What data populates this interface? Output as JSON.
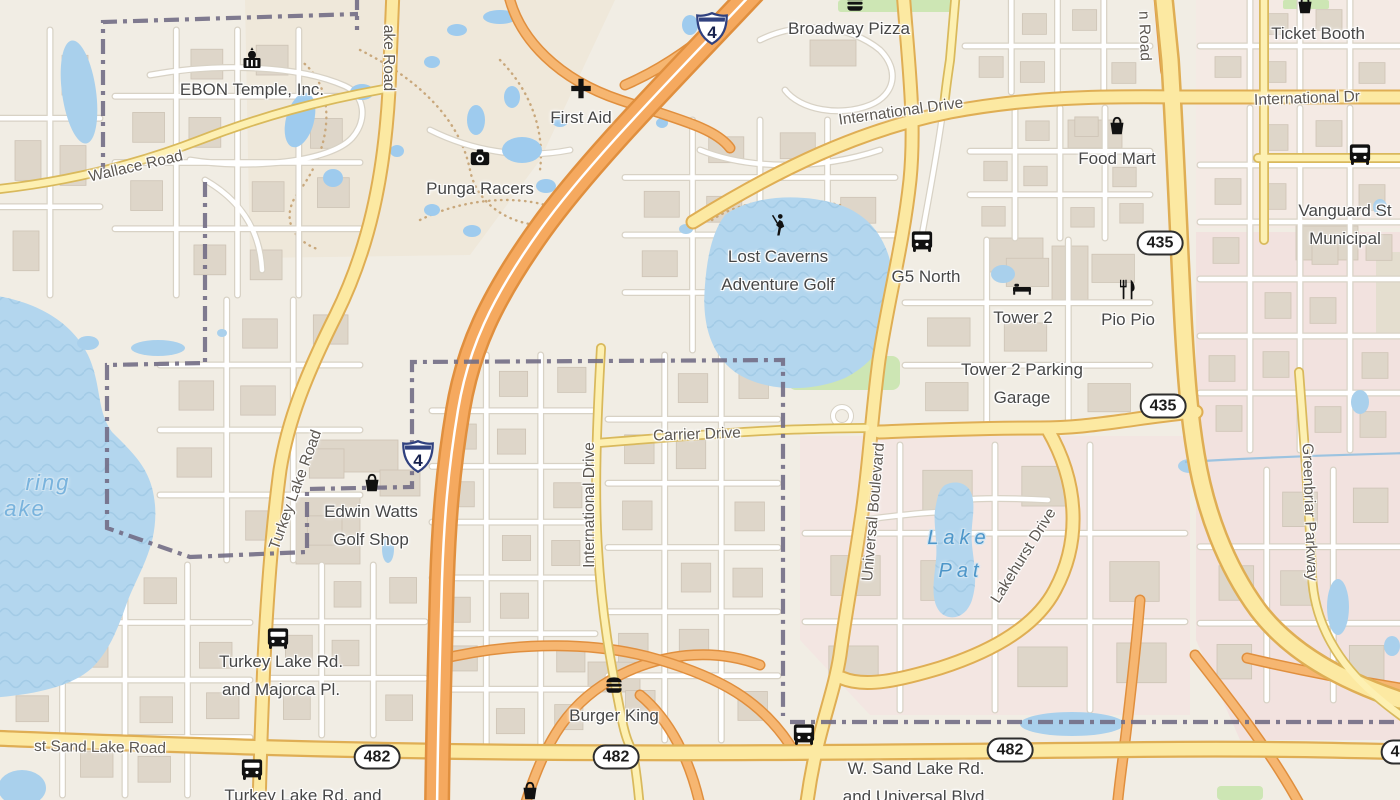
{
  "map": {
    "colors": {
      "land": "#f1ede4",
      "water": "#b3d6ee",
      "pool": "#9ecbee",
      "pond": "#a9d0ec",
      "building": "#ded6c9",
      "street": "#ffffff",
      "street_casing": "#d8d2c5",
      "road_fill": "#fce9a2",
      "road_casing": "#dfae54",
      "motorway_fill": "#f5a95f",
      "motorway_casing": "#e08f3e",
      "boundary": "#726d85",
      "grass": "#cde6b4",
      "poi_text": "#474747",
      "road_text": "#5d5852",
      "water_text": "#4d96c9"
    },
    "poi_labels": [
      {
        "lines": [
          "EBON Temple, Inc."
        ],
        "x": 252,
        "y": 90
      },
      {
        "lines": [
          "First Aid"
        ],
        "x": 581,
        "y": 118
      },
      {
        "lines": [
          "Punga Racers"
        ],
        "x": 480,
        "y": 189
      },
      {
        "lines": [
          "Broadway Pizza"
        ],
        "x": 849,
        "y": 29
      },
      {
        "lines": [
          "Ticket Booth"
        ],
        "x": 1318,
        "y": 34
      },
      {
        "lines": [
          "Food Mart"
        ],
        "x": 1117,
        "y": 159
      },
      {
        "lines": [
          "Vanguard St",
          "Municipal"
        ],
        "x": 1345,
        "y": 225
      },
      {
        "lines": [
          "Lost Caverns",
          "Adventure Golf"
        ],
        "x": 778,
        "y": 271
      },
      {
        "lines": [
          "G5 North"
        ],
        "x": 926,
        "y": 277
      },
      {
        "lines": [
          "Tower 2"
        ],
        "x": 1023,
        "y": 318
      },
      {
        "lines": [
          "Pio Pio"
        ],
        "x": 1128,
        "y": 320
      },
      {
        "lines": [
          "Tower 2 Parking",
          "Garage"
        ],
        "x": 1022,
        "y": 384
      },
      {
        "lines": [
          "Edwin Watts",
          "Golf Shop"
        ],
        "x": 371,
        "y": 526
      },
      {
        "lines": [
          "Turkey Lake Rd.",
          "and Majorca Pl."
        ],
        "x": 281,
        "y": 676
      },
      {
        "lines": [
          "Burger King"
        ],
        "x": 614,
        "y": 716
      },
      {
        "lines": [
          "W. Sand Lake Rd.",
          "and Universal Blvd."
        ],
        "x": 916,
        "y": 783
      },
      {
        "lines": [
          "Turkey Lake Rd. and"
        ],
        "x": 303,
        "y": 796
      }
    ],
    "road_labels": [
      {
        "text": "Wallace Road",
        "x": 136,
        "y": 167,
        "rot": -13
      },
      {
        "text": "ake Road",
        "x": 388,
        "y": 58,
        "rot": 90
      },
      {
        "text": "International Drive",
        "x": 901,
        "y": 112,
        "rot": -8
      },
      {
        "text": "International Dr",
        "x": 1307,
        "y": 99,
        "rot": -2
      },
      {
        "text": "n Road",
        "x": 1144,
        "y": 36,
        "rot": 88
      },
      {
        "text": "Carrier Drive",
        "x": 697,
        "y": 435,
        "rot": -2
      },
      {
        "text": "International Drive",
        "x": 590,
        "y": 505,
        "rot": -90
      },
      {
        "text": "Universal Boulevard",
        "x": 874,
        "y": 512,
        "rot": -85
      },
      {
        "text": "Lakehurst Drive",
        "x": 1024,
        "y": 556,
        "rot": -58
      },
      {
        "text": "Greenbriar Parkway",
        "x": 1309,
        "y": 512,
        "rot": 88
      },
      {
        "text": "Turkey Lake Road",
        "x": 296,
        "y": 490,
        "rot": -70
      },
      {
        "text": "st Sand Lake Road",
        "x": 100,
        "y": 748,
        "rot": 1
      }
    ],
    "water_labels": [
      {
        "text": "ring",
        "x": 48,
        "y": 483,
        "big": true
      },
      {
        "text": "ake",
        "x": 25,
        "y": 509,
        "big": true
      },
      {
        "text": "Lake",
        "x": 959,
        "y": 538,
        "big": false
      },
      {
        "text": "Pat",
        "x": 961,
        "y": 571,
        "big": false
      }
    ],
    "shields": {
      "interstate": [
        {
          "text": "4",
          "x": 712,
          "y": 31
        },
        {
          "text": "4",
          "x": 418,
          "y": 459
        }
      ],
      "oval": [
        {
          "text": "435",
          "x": 1160,
          "y": 243
        },
        {
          "text": "435",
          "x": 1163,
          "y": 406
        },
        {
          "text": "482",
          "x": 377,
          "y": 757
        },
        {
          "text": "482",
          "x": 616,
          "y": 757
        },
        {
          "text": "482",
          "x": 1010,
          "y": 750
        },
        {
          "text": "482",
          "x": 1404,
          "y": 752
        }
      ]
    },
    "icons": [
      {
        "name": "temple-icon",
        "x": 252,
        "y": 62,
        "s": 30
      },
      {
        "name": "firstaid-icon",
        "x": 581,
        "y": 91,
        "s": 26
      },
      {
        "name": "camera-icon",
        "x": 480,
        "y": 160,
        "s": 26
      },
      {
        "name": "burger-icon",
        "x": 855,
        "y": 6,
        "s": 26
      },
      {
        "name": "burger-icon",
        "x": 614,
        "y": 688,
        "s": 26
      },
      {
        "name": "basket-icon",
        "x": 1117,
        "y": 129,
        "s": 26
      },
      {
        "name": "basket-icon",
        "x": 1305,
        "y": 8,
        "s": 26
      },
      {
        "name": "basket-icon",
        "x": 372,
        "y": 486,
        "s": 26
      },
      {
        "name": "basket-icon",
        "x": 530,
        "y": 794,
        "s": 26
      },
      {
        "name": "bus-icon",
        "x": 922,
        "y": 244,
        "s": 27
      },
      {
        "name": "bus-icon",
        "x": 1360,
        "y": 157,
        "s": 27
      },
      {
        "name": "bus-icon",
        "x": 278,
        "y": 641,
        "s": 27
      },
      {
        "name": "bus-icon",
        "x": 804,
        "y": 737,
        "s": 27
      },
      {
        "name": "bus-icon",
        "x": 252,
        "y": 772,
        "s": 27
      },
      {
        "name": "bed-icon",
        "x": 1022,
        "y": 290,
        "s": 24
      },
      {
        "name": "restaurant-icon",
        "x": 1128,
        "y": 292,
        "s": 26
      },
      {
        "name": "golfer-icon",
        "x": 777,
        "y": 228,
        "s": 28
      }
    ],
    "geometry": {
      "areas": [
        {
          "path": "M245,0 L615,0 L540,160 L470,255 L250,258 Z",
          "fill": "#efe8da"
        },
        {
          "path": "M1196,0 H1400 V228 H1196 Z",
          "fill": "#f4eae4"
        },
        {
          "path": "M1196,232 H1400 V740 H1240 L1196,640 Z",
          "fill": "#f2e2df"
        },
        {
          "path": "M800,436 L1190,436 L1190,715 L870,715 L800,640 Z",
          "fill": "#f3e6e2"
        },
        {
          "path": "M1376,252 H1400 V334 H1376 Z",
          "fill": "#e4decf"
        }
      ],
      "greens": [
        {
          "x": 788,
          "y": 356,
          "w": 112,
          "h": 34,
          "r": 8
        },
        {
          "x": 838,
          "y": 0,
          "w": 120,
          "h": 12,
          "r": 3
        },
        {
          "x": 1283,
          "y": 0,
          "w": 46,
          "h": 9,
          "r": 2
        },
        {
          "x": 1217,
          "y": 786,
          "w": 46,
          "h": 14,
          "r": 4
        }
      ],
      "buildings": [
        {
          "x": 318,
          "y": 440,
          "w": 80,
          "h": 32
        },
        {
          "x": 296,
          "y": 498,
          "w": 64,
          "h": 66
        },
        {
          "x": 380,
          "y": 470,
          "w": 40,
          "h": 26
        },
        {
          "x": 985,
          "y": 238,
          "w": 58,
          "h": 34
        },
        {
          "x": 1052,
          "y": 246,
          "w": 36,
          "h": 56
        },
        {
          "x": 1068,
          "y": 120,
          "w": 54,
          "h": 28
        },
        {
          "x": 588,
          "y": 662,
          "w": 52,
          "h": 30
        },
        {
          "x": 810,
          "y": 40,
          "w": 46,
          "h": 26
        },
        {
          "x": 1296,
          "y": 226,
          "w": 62,
          "h": 34
        }
      ],
      "grids": [
        {
          "x0": 965,
          "y0": 0,
          "x1": 1150,
          "y1": 92,
          "nv": 3,
          "nh": 1
        },
        {
          "x0": 1200,
          "y0": 0,
          "x1": 1400,
          "y1": 92,
          "nv": 3,
          "nh": 1
        },
        {
          "x0": 970,
          "y0": 108,
          "x1": 1150,
          "y1": 238,
          "nv": 3,
          "nh": 2
        },
        {
          "x0": 1200,
          "y0": 108,
          "x1": 1400,
          "y1": 450,
          "nv": 3,
          "nh": 5
        },
        {
          "x0": 115,
          "y0": 30,
          "x1": 360,
          "y1": 295,
          "nv": 3,
          "nh": 3
        },
        {
          "x0": 0,
          "y0": 30,
          "x1": 100,
          "y1": 295,
          "nv": 1,
          "nh": 2
        },
        {
          "x0": 432,
          "y0": 355,
          "x1": 595,
          "y1": 745,
          "nv": 2,
          "nh": 6
        },
        {
          "x0": 608,
          "y0": 355,
          "x1": 778,
          "y1": 740,
          "nv": 2,
          "nh": 5
        },
        {
          "x0": 625,
          "y0": 120,
          "x1": 895,
          "y1": 350,
          "nv": 3,
          "nh": 3
        },
        {
          "x0": 0,
          "y0": 565,
          "x1": 250,
          "y1": 795,
          "nv": 3,
          "nh": 3
        },
        {
          "x0": 270,
          "y0": 565,
          "x1": 425,
          "y1": 735,
          "nv": 2,
          "nh": 2
        },
        {
          "x0": 1200,
          "y0": 470,
          "x1": 1400,
          "y1": 700,
          "nv": 2,
          "nh": 2
        },
        {
          "x0": 805,
          "y0": 445,
          "x1": 1185,
          "y1": 710,
          "nv": 3,
          "nh": 2
        },
        {
          "x0": 905,
          "y0": 240,
          "x1": 1150,
          "y1": 428,
          "nv": 2,
          "nh": 2
        },
        {
          "x0": 160,
          "y0": 300,
          "x1": 360,
          "y1": 560,
          "nv": 2,
          "nh": 3
        }
      ],
      "streets": [
        "M150,75 C220,62 300,66 345,86 C365,95 368,120 352,138 C330,162 250,170 190,160",
        "M205,180 C240,200 260,230 262,270",
        "M430,130 C470,150 520,160 570,150",
        "M760,40 C800,20 850,25 880,50 C900,70 895,95 870,105 C840,117 800,110 785,90",
        "M700,150 C750,170 820,170 880,150",
        "M862,520 C900,515 930,512 945,512",
        "M1048,500 C1010,498 980,498 960,500",
        "M944,103 C938,150 930,190 922,235"
      ],
      "dotted": [
        "M300,60 C340,90 330,150 300,190 C280,215 290,240 320,250",
        "M360,50 C420,80 460,120 470,170 C478,210 520,230 560,225",
        "M420,220 C460,200 510,195 545,205",
        "M500,60 C530,90 545,130 540,170",
        "M712,220 C740,200 790,195 840,205"
      ],
      "waters": [
        {
          "path": "M-10,295 C30,300 70,318 88,355 C102,385 96,410 112,432 C135,455 152,470 155,505 C158,545 140,570 128,600 C118,628 110,650 92,668 C70,688 30,695 -10,698 Z",
          "waves": true
        },
        {
          "path": "M725,215 C750,196 800,192 840,205 C875,217 893,248 894,290 C895,330 880,360 845,378 C805,395 755,390 730,368 C708,348 702,318 705,285 C707,258 712,232 725,215 Z",
          "waves": true
        },
        {
          "path": "M945,485 C955,480 968,482 972,495 C976,510 970,525 972,545 C974,565 978,580 972,600 C966,618 950,622 940,612 C930,600 934,580 936,560 C938,540 932,520 936,505 C938,494 940,489 945,485 Z",
          "waves": true
        },
        {
          "cx": 79,
          "cy": 92,
          "rx": 17,
          "ry": 52,
          "rot": -8
        },
        {
          "cx": 22,
          "cy": 788,
          "rx": 24,
          "ry": 18
        },
        {
          "cx": 300,
          "cy": 120,
          "rx": 14,
          "ry": 28,
          "rot": 15,
          "pool": true
        },
        {
          "cx": 333,
          "cy": 178,
          "rx": 10,
          "ry": 9,
          "pool": true
        },
        {
          "cx": 362,
          "cy": 92,
          "rx": 12,
          "ry": 8,
          "pool": true
        },
        {
          "cx": 432,
          "cy": 62,
          "rx": 8,
          "ry": 6,
          "pool": true
        },
        {
          "cx": 457,
          "cy": 30,
          "rx": 10,
          "ry": 6,
          "pool": true
        },
        {
          "cx": 500,
          "cy": 17,
          "rx": 17,
          "ry": 7,
          "pool": true
        },
        {
          "cx": 476,
          "cy": 120,
          "rx": 9,
          "ry": 15,
          "pool": true
        },
        {
          "cx": 522,
          "cy": 150,
          "rx": 20,
          "ry": 13,
          "pool": true
        },
        {
          "cx": 546,
          "cy": 186,
          "rx": 10,
          "ry": 7,
          "pool": true
        },
        {
          "cx": 432,
          "cy": 210,
          "rx": 8,
          "ry": 6,
          "pool": true
        },
        {
          "cx": 397,
          "cy": 151,
          "rx": 7,
          "ry": 6,
          "pool": true
        },
        {
          "cx": 472,
          "cy": 231,
          "rx": 9,
          "ry": 6,
          "pool": true
        },
        {
          "cx": 512,
          "cy": 97,
          "rx": 8,
          "ry": 11,
          "pool": true
        },
        {
          "cx": 560,
          "cy": 121,
          "rx": 8,
          "ry": 6,
          "pool": true
        },
        {
          "cx": 690,
          "cy": 25,
          "rx": 8,
          "ry": 10,
          "pool": true
        },
        {
          "cx": 662,
          "cy": 123,
          "rx": 6,
          "ry": 5,
          "pool": true
        },
        {
          "cx": 222,
          "cy": 333,
          "rx": 5,
          "ry": 4
        },
        {
          "cx": 686,
          "cy": 229,
          "rx": 7,
          "ry": 5
        },
        {
          "cx": 1003,
          "cy": 274,
          "rx": 12,
          "ry": 9
        },
        {
          "cx": 388,
          "cy": 549,
          "rx": 6,
          "ry": 14
        },
        {
          "cx": 88,
          "cy": 343,
          "rx": 11,
          "ry": 7
        },
        {
          "cx": 158,
          "cy": 348,
          "rx": 27,
          "ry": 8
        },
        {
          "cx": 1190,
          "cy": 466,
          "rx": 12,
          "ry": 7
        },
        {
          "cx": 1360,
          "cy": 402,
          "rx": 9,
          "ry": 12
        },
        {
          "cx": 1338,
          "cy": 607,
          "rx": 11,
          "ry": 28
        },
        {
          "cx": 1392,
          "cy": 646,
          "rx": 8,
          "ry": 10
        },
        {
          "cx": 1072,
          "cy": 724,
          "rx": 52,
          "ry": 12
        },
        {
          "cx": 1380,
          "cy": 207,
          "rx": 7,
          "ry": 8
        }
      ],
      "streams": [
        "M1185,462 C1250,458 1330,455 1410,453"
      ],
      "roads": [
        {
          "cls": "ramp",
          "path": "M508,-8 C518,40 560,80 620,100 C680,120 715,128 730,148"
        },
        {
          "cls": "ramp",
          "path": "M755,-8 C700,45 660,70 625,85"
        },
        {
          "cls": "ramp",
          "path": "M525,805 C545,740 570,700 620,675 C670,650 720,650 760,665"
        },
        {
          "cls": "ramp",
          "path": "M700,805 C690,760 670,720 640,695"
        },
        {
          "cls": "ramp",
          "path": "M437,660 C520,640 600,642 660,660 C720,678 760,700 790,745"
        },
        {
          "cls": "ramp",
          "path": "M1140,600 C1136,650 1130,700 1124,750 C1120,780 1118,795 1117,810"
        },
        {
          "cls": "ramp",
          "path": "M1195,655 C1230,700 1270,750 1300,805"
        },
        {
          "cls": "ramp",
          "path": "M1247,658 C1290,668 1350,680 1400,688"
        },
        {
          "cls": "ramp",
          "path": "M1163,-8 L1170,70",
          "wc": 20,
          "wf": 15
        },
        {
          "cls": "sec",
          "path": "M693,222 C780,168 860,130 950,112 C1030,97 1100,96 1180,97 L1410,97"
        },
        {
          "cls": "sec",
          "path": "M903,-10 C908,60 916,120 910,180 C903,245 888,300 879,360 C871,420 869,470 861,520 C853,575 846,610 840,655 C833,700 815,735 806,810"
        },
        {
          "cls": "sec",
          "path": "M393,-10 L389,90 C384,180 368,250 336,315 C306,375 288,420 280,470 C272,530 267,600 264,660 C262,710 260,760 259,810"
        },
        {
          "cls": "sec",
          "path": "M-10,738 C150,744 300,750 500,752 C700,754 900,752 1100,750 C1250,748 1330,750 1410,752",
          "wc": 17,
          "wf": 12.5
        },
        {
          "cls": "sec",
          "path": "M1163,-10 L1170,60 C1175,140 1178,220 1182,300 C1186,380 1190,420 1196,455 C1205,510 1225,565 1258,610 C1290,652 1340,680 1400,700",
          "wc": 20,
          "wf": 15
        },
        {
          "cls": "sec",
          "path": "M879,432 C930,430 990,428 1040,428 C1075,428 1100,424 1130,420 C1150,417 1170,414 1196,412"
        },
        {
          "cls": "sec",
          "path": "M1048,430 C1078,482 1082,540 1055,590 C1035,628 990,652 940,668 C900,680 865,688 842,678"
        },
        {
          "cls": "ter",
          "path": "M-10,190 C60,183 130,167 200,140 C260,117 320,100 390,88"
        },
        {
          "cls": "ter",
          "path": "M598,443 C660,438 720,433 780,430 C810,429 840,428 866,428"
        },
        {
          "cls": "ter",
          "path": "M601,348 C597,420 594,490 598,550 C602,620 612,670 622,720 C626,740 630,746 633,753"
        },
        {
          "cls": "ter",
          "path": "M633,753 C636,770 638,785 640,810"
        },
        {
          "cls": "ter",
          "path": "M1264,-10 L1264,240"
        },
        {
          "cls": "ter",
          "path": "M1258,158 L1410,158"
        },
        {
          "cls": "ter",
          "path": "M1299,372 C1305,450 1310,520 1312,575 C1314,625 1340,665 1375,695 C1390,708 1400,715 1410,722"
        },
        {
          "cls": "ter",
          "path": "M956,-10 L950,60 C947,80 945,95 944,108"
        },
        {
          "cls": "mot",
          "path": "M755,-10 C680,70 590,160 540,230 C490,300 468,350 458,410 C448,470 444,520 442,580 C440,650 438,720 437,810"
        }
      ],
      "boundaries": [
        "M103,178 L103,22 L358,14",
        "M357,-5 L357,30",
        "M205,182 L205,363 L107,365 L107,528 L190,557 L307,552 L307,489 L412,487 L412,362 L783,360 L783,716",
        "M790,722 L1410,722"
      ]
    }
  }
}
